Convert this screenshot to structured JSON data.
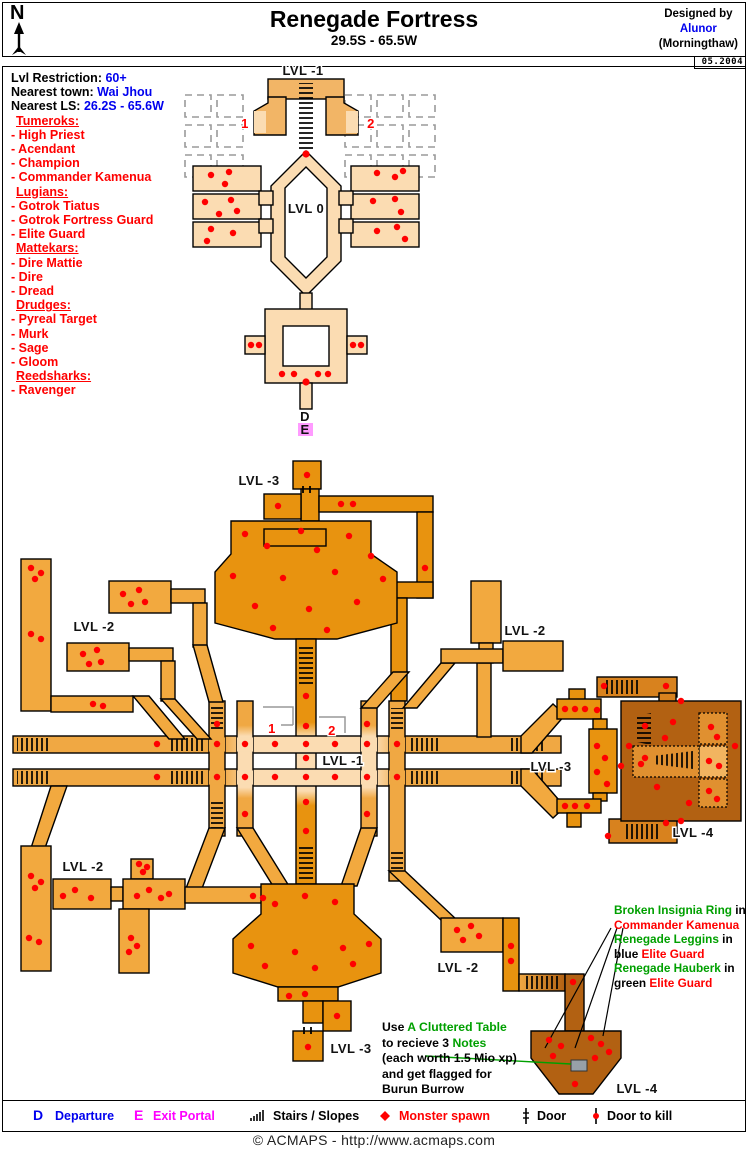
{
  "header": {
    "title": "Renegade Fortress",
    "coords": "29.5S - 65.5W",
    "designed_by": "Designed by",
    "designer": "Alunor",
    "server": "(Morningthaw)",
    "date": "05.2004",
    "compass": "N"
  },
  "info": {
    "rows": [
      {
        "label": "Lvl Restriction:",
        "value": "60+"
      },
      {
        "label": "Nearest town:",
        "value": "Wai Jhou"
      },
      {
        "label": "Nearest LS:",
        "value": "26.2S - 65.6W"
      }
    ]
  },
  "creatures": {
    "groups": [
      {
        "name": "Tumeroks:",
        "members": [
          "- High Priest",
          "- Acendant",
          "- Champion",
          "- Commander Kamenua"
        ]
      },
      {
        "name": "Lugians:",
        "members": [
          "- Gotrok Tiatus",
          "- Gotrok Fortress Guard",
          "- Elite Guard"
        ]
      },
      {
        "name": "Mattekars:",
        "members": [
          "- Dire Mattie",
          "- Dire",
          "- Dread"
        ]
      },
      {
        "name": "Drudges:",
        "members": [
          "- Pyreal Target",
          "- Murk",
          "- Sage",
          "- Gloom"
        ]
      },
      {
        "name": "Reedsharks:",
        "members": [
          "- Ravenger"
        ]
      }
    ]
  },
  "map_top": {
    "labels": {
      "lvl_minus_1": "LVL -1",
      "lvl_0": "LVL 0",
      "portal_1": "1",
      "portal_2": "2",
      "departure": "D",
      "exit": "E"
    }
  },
  "map_bottom": {
    "labels": {
      "lvl3_top": "LVL -3",
      "lvl2_left": "LVL -2",
      "lvl2_right": "LVL -2",
      "lvl1_center": "LVL -1",
      "portal_1": "1",
      "portal_2": "2",
      "lvl3_right": "LVL -3",
      "lvl4_right": "LVL -4",
      "lvl2_bottom_left": "LVL -2",
      "lvl2_bottom_right": "LVL -2",
      "lvl3_bottom": "LVL -3",
      "lvl4_bottom": "LVL -4"
    }
  },
  "annotations": {
    "loot_note": {
      "lines": [
        {
          "a": "Broken Insignia Ring",
          "a_color": "green",
          "b": " in",
          "b_color": "black"
        },
        {
          "a": "Commander Kamenua",
          "a_color": "red",
          "b": "",
          "b_color": "black"
        },
        {
          "a": "Renegade Leggins",
          "a_color": "green",
          "b": " in",
          "b_color": "black"
        },
        {
          "a": "blue ",
          "a_color": "black",
          "b": "Elite Guard",
          "b_color": "red"
        },
        {
          "a": "Renegade Hauberk",
          "a_color": "green",
          "b": " in",
          "b_color": "black"
        },
        {
          "a": "green ",
          "a_color": "black",
          "b": "Elite Guard",
          "b_color": "red"
        }
      ]
    },
    "table_note": {
      "lines": [
        {
          "a": "Use ",
          "a_color": "black",
          "b": "A Cluttered Table",
          "b_color": "green"
        },
        {
          "a": "to recieve 3 ",
          "a_color": "black",
          "b": "Notes",
          "b_color": "green"
        },
        {
          "a": "(each worth 1.5 Mio xp)",
          "a_color": "black",
          "b": ""
        },
        {
          "a": "and get flagged for",
          "a_color": "black",
          "b": ""
        },
        {
          "a": "Burun Burrow",
          "a_color": "black",
          "b": ""
        }
      ]
    }
  },
  "legend": {
    "items": [
      {
        "symbol": "D",
        "label": "Departure",
        "color": "#0000EE"
      },
      {
        "symbol": "E",
        "label": "Exit Portal",
        "color": "#FF00FF"
      },
      {
        "icon": "stairs-icon",
        "label": "Stairs / Slopes",
        "color": "#000000"
      },
      {
        "icon": "monster-spawn-icon",
        "label": "Monster spawn",
        "color": "#FF0000"
      },
      {
        "icon": "door-icon",
        "label": "Door",
        "color": "#000000"
      },
      {
        "icon": "door-to-kill-icon",
        "label": "Door to kill",
        "color": "#000000"
      }
    ]
  },
  "footer": {
    "copyright": "© ACMAPS - http://www.acmaps.com"
  },
  "colors": {
    "accent_blue": "#0000EE",
    "magenta": "#FF00FF",
    "red": "#FF0000",
    "green": "#00A000",
    "map_peach": "#FBDCB2",
    "map_sand": "#F2B566",
    "map_orange": "#F0A843",
    "map_dark_orange": "#E8930F",
    "map_brown": "#B26112",
    "grid_gray": "#999999"
  }
}
